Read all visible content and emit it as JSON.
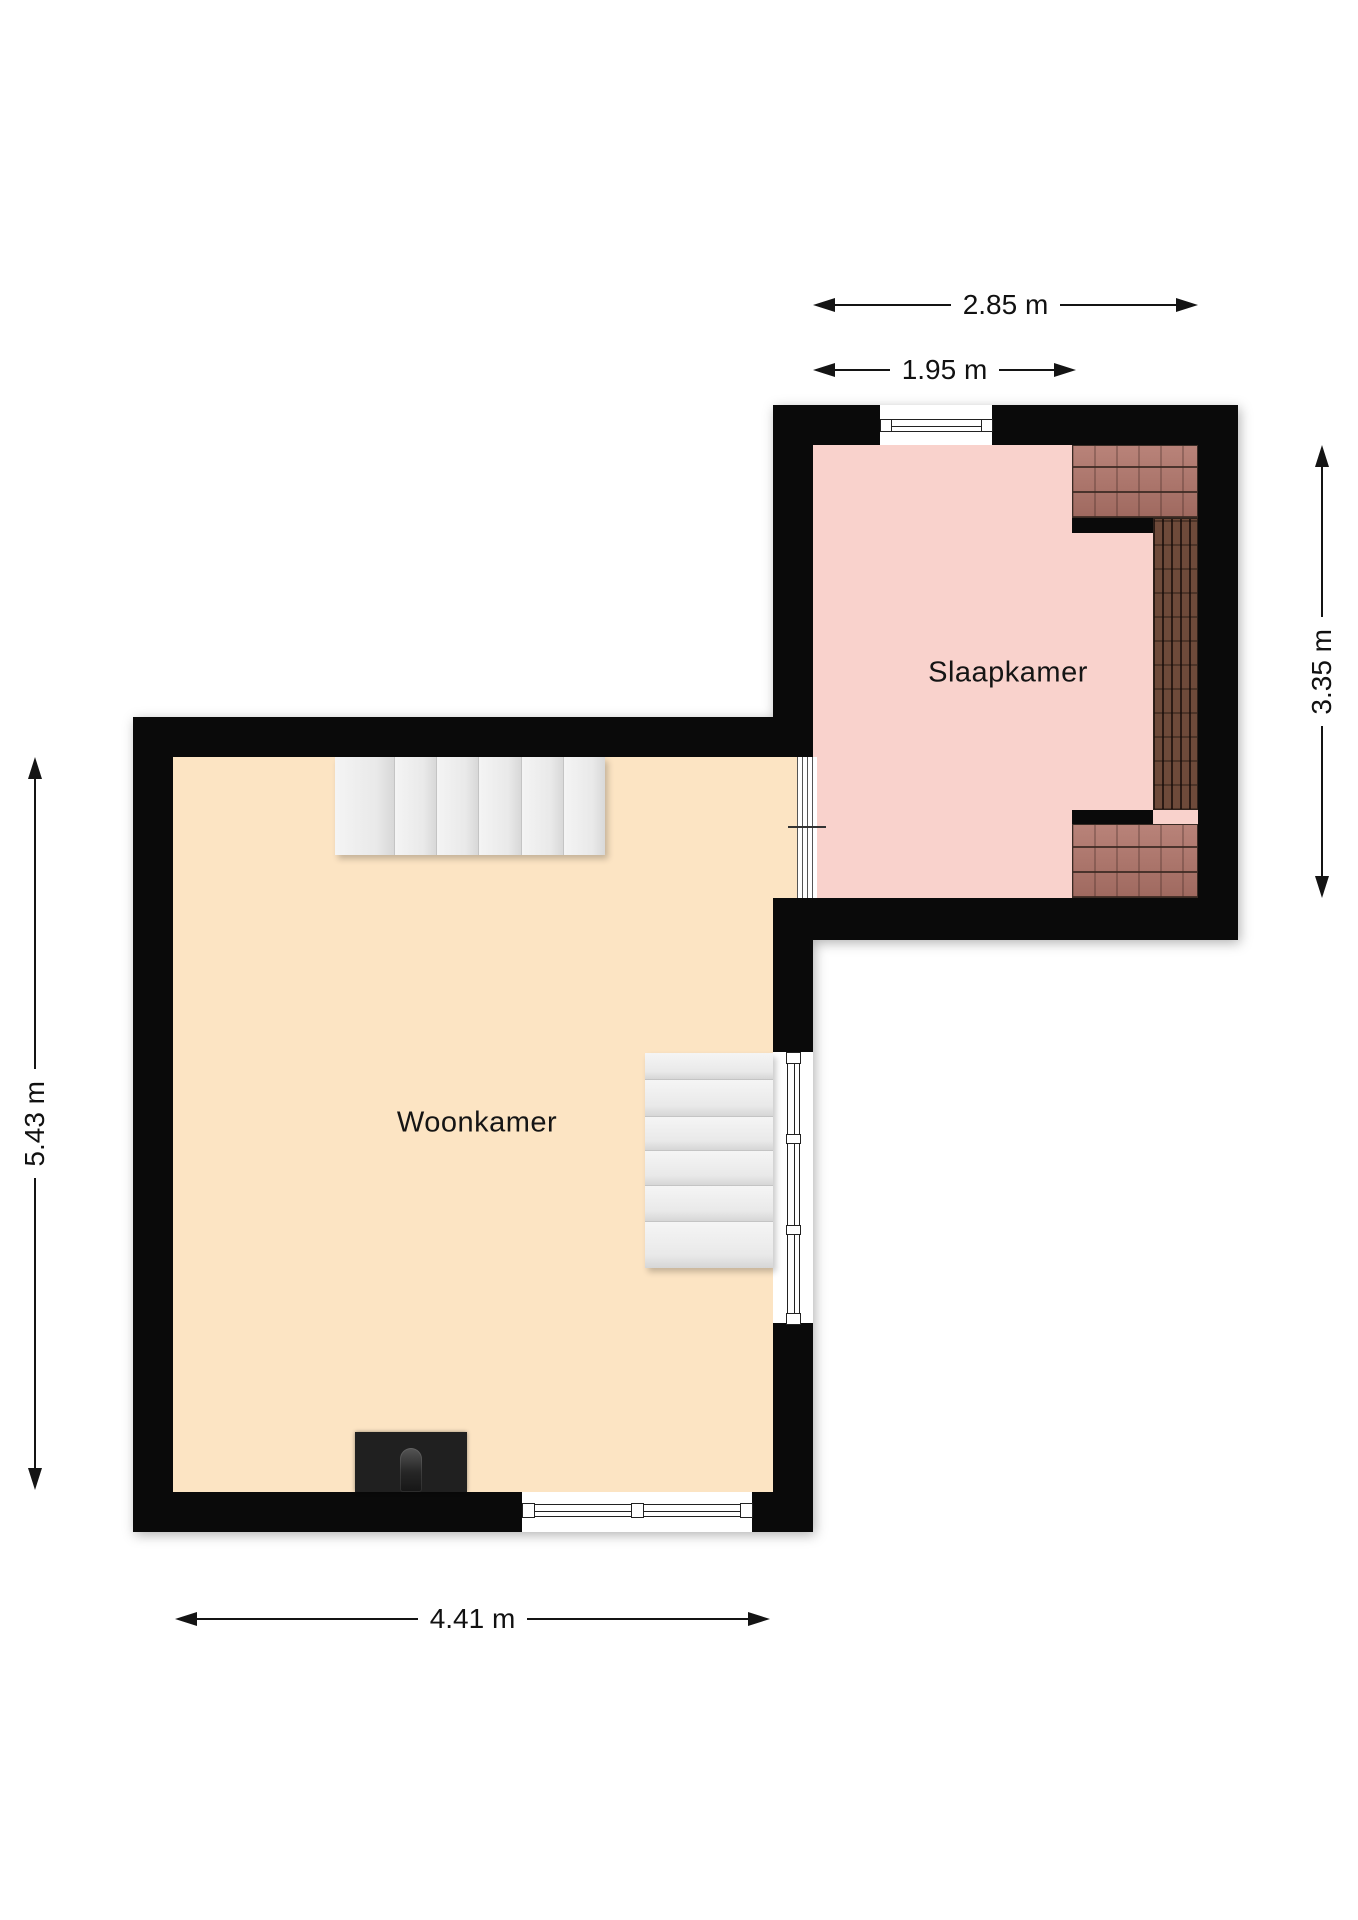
{
  "plan": {
    "type": "floorplan",
    "rooms": {
      "slaapkamer": {
        "label": "Slaapkamer",
        "floor_color": "#f9d2cc"
      },
      "woonkamer": {
        "label": "Woonkamer",
        "floor_color": "#fce4c3"
      }
    },
    "dimensions": {
      "bedroom_width_total": {
        "label": "2.85 m",
        "orientation": "horizontal"
      },
      "bedroom_width_flat": {
        "label": "1.95 m",
        "orientation": "horizontal"
      },
      "bedroom_depth": {
        "label": "3.35 m",
        "orientation": "vertical"
      },
      "livingroom_height": {
        "label": "5.43 m",
        "orientation": "vertical"
      },
      "livingroom_width": {
        "label": "4.41 m",
        "orientation": "horizontal"
      }
    },
    "features": {
      "stairs_top": "staircase",
      "stairs_middle": "staircase",
      "fireplace": "chimney-fireplace",
      "roof_slope": "roof-tile-hatching",
      "windows": [
        "bedroom-top-window",
        "livingroom-right-window",
        "livingroom-bottom-window",
        "interior-glass-partition"
      ]
    },
    "colors": {
      "wall": "#0a0a0a",
      "tile_light": "#b1756a",
      "tile_dark": "#6e4a3a",
      "stairs": "#ececec",
      "dimension_lines": "#141414"
    }
  }
}
